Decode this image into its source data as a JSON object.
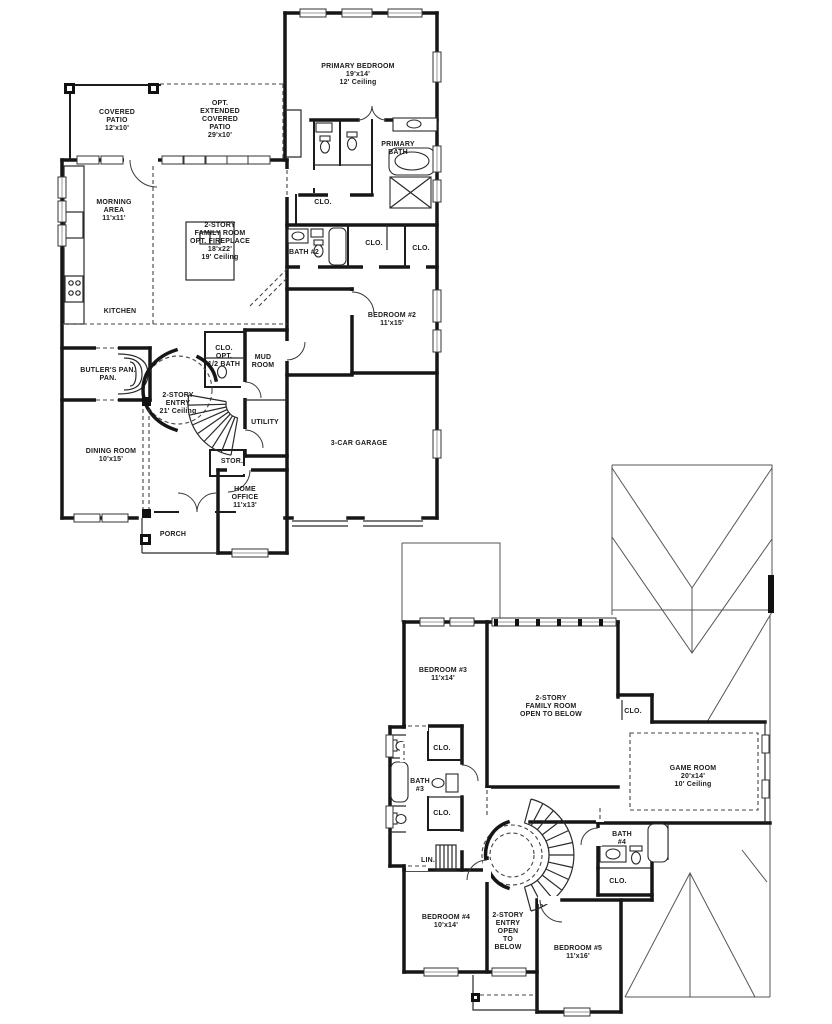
{
  "title": "Two-story home floor plan",
  "floor1_labels": [
    {
      "id": "primary-bedroom",
      "lines": [
        "PRIMARY BEDROOM",
        "19'x14'",
        "12' Ceiling"
      ]
    },
    {
      "id": "covered-patio",
      "lines": [
        "COVERED",
        "PATIO",
        "12'x10'"
      ]
    },
    {
      "id": "opt-extended-covered-patio",
      "lines": [
        "OPT.",
        "EXTENDED",
        "COVERED",
        "PATIO",
        "29'x10'"
      ]
    },
    {
      "id": "morning-area",
      "lines": [
        "MORNING",
        "AREA",
        "11'x11'"
      ]
    },
    {
      "id": "family-room",
      "lines": [
        "2-STORY",
        "FAMILY ROOM",
        "OPT. FIREPLACE",
        "18'x22'",
        "19' Ceiling"
      ]
    },
    {
      "id": "primary-bath",
      "lines": [
        "PRIMARY",
        "BATH"
      ]
    },
    {
      "id": "primary-closet",
      "lines": [
        "CLO."
      ]
    },
    {
      "id": "bath-2",
      "lines": [
        "BATH #2"
      ]
    },
    {
      "id": "closet-mid",
      "lines": [
        "CLO."
      ]
    },
    {
      "id": "closet-right",
      "lines": [
        "CLO."
      ]
    },
    {
      "id": "bedroom-2",
      "lines": [
        "BEDROOM #2",
        "11'x15'"
      ]
    },
    {
      "id": "kitchen",
      "lines": [
        "KITCHEN"
      ]
    },
    {
      "id": "butlers-pantry",
      "lines": [
        "BUTLER'S PAN.",
        "PAN."
      ]
    },
    {
      "id": "clo-opt-half-bath",
      "lines": [
        "CLO.",
        "OPT.",
        "1/2 BATH"
      ]
    },
    {
      "id": "mud-room",
      "lines": [
        "MUD",
        "ROOM"
      ]
    },
    {
      "id": "two-story-entry",
      "lines": [
        "2-STORY",
        "ENTRY",
        "21' Ceiling"
      ]
    },
    {
      "id": "utility",
      "lines": [
        "UTILITY"
      ]
    },
    {
      "id": "dining-room",
      "lines": [
        "DINING ROOM",
        "10'x15'"
      ]
    },
    {
      "id": "storage",
      "lines": [
        "STOR."
      ]
    },
    {
      "id": "home-office",
      "lines": [
        "HOME",
        "OFFICE",
        "11'x13'"
      ]
    },
    {
      "id": "porch",
      "lines": [
        "PORCH"
      ]
    },
    {
      "id": "garage",
      "lines": [
        "3-CAR GARAGE"
      ]
    }
  ],
  "floor2_labels": [
    {
      "id": "bedroom-3",
      "lines": [
        "BEDROOM #3",
        "11'x14'"
      ]
    },
    {
      "id": "family-room-open",
      "lines": [
        "2-STORY",
        "FAMILY ROOM",
        "OPEN TO BELOW"
      ]
    },
    {
      "id": "closet-family",
      "lines": [
        "CLO."
      ]
    },
    {
      "id": "game-room",
      "lines": [
        "GAME ROOM",
        "20'x14'",
        "10' Ceiling"
      ]
    },
    {
      "id": "closet-bath3-top",
      "lines": [
        "CLO."
      ]
    },
    {
      "id": "bath-3",
      "lines": [
        "BATH",
        "#3"
      ]
    },
    {
      "id": "closet-bath3-bottom",
      "lines": [
        "CLO."
      ]
    },
    {
      "id": "linen",
      "lines": [
        "LIN."
      ]
    },
    {
      "id": "bath-4",
      "lines": [
        "BATH",
        "#4"
      ]
    },
    {
      "id": "closet-bath4",
      "lines": [
        "CLO."
      ]
    },
    {
      "id": "bedroom-4",
      "lines": [
        "BEDROOM #4",
        "10'x14'"
      ]
    },
    {
      "id": "entry-open",
      "lines": [
        "2-STORY",
        "ENTRY",
        "OPEN",
        "TO",
        "BELOW"
      ]
    },
    {
      "id": "bedroom-5",
      "lines": [
        "BEDROOM #5",
        "11'x16'"
      ]
    }
  ]
}
